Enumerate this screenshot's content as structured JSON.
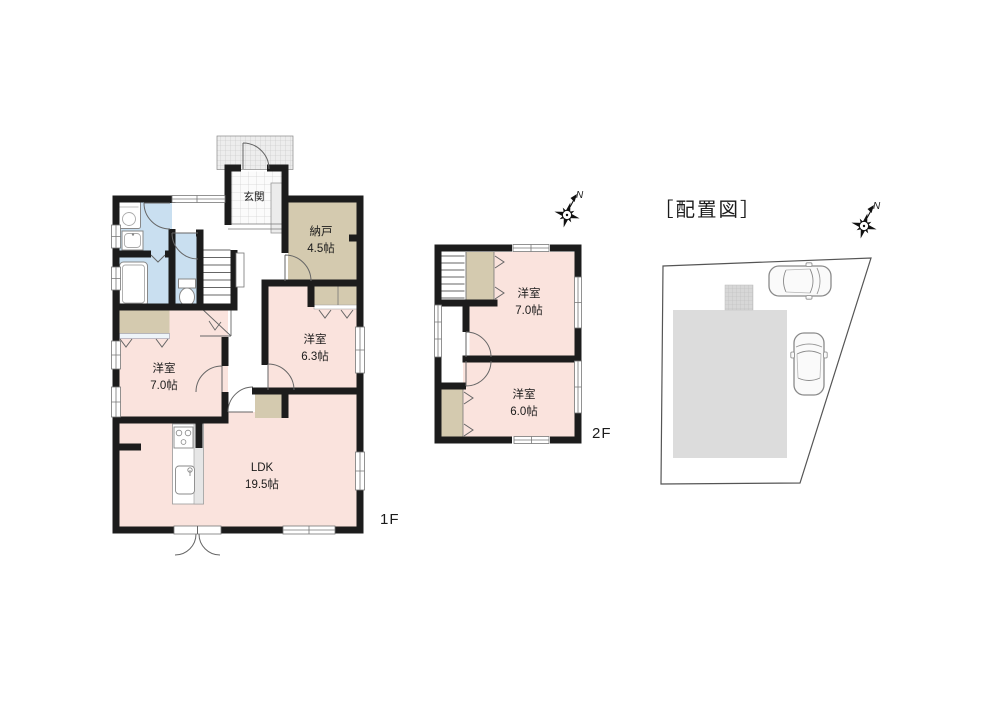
{
  "document": {
    "type": "floor-plan",
    "background": "#ffffff"
  },
  "palette": {
    "wall": "#1c1c1c",
    "room_pink": "#fae3dd",
    "closet_beige": "#d4caaf",
    "wet_area_blue": "#c9dff0",
    "building_gray": "#dcdcdc",
    "line_gray": "#666666"
  },
  "floor1": {
    "floor_label": "1F",
    "rooms": {
      "genkan": {
        "name": "玄関"
      },
      "nando": {
        "name": "納戸",
        "size": "4.5帖"
      },
      "bedroom_7": {
        "name": "洋室",
        "size": "7.0帖"
      },
      "bedroom_63": {
        "name": "洋室",
        "size": "6.3帖"
      },
      "ldk": {
        "name": "LDK",
        "size": "19.5帖"
      }
    }
  },
  "floor2": {
    "floor_label": "2F",
    "rooms": {
      "bedroom_7": {
        "name": "洋室",
        "size": "7.0帖"
      },
      "bedroom_6": {
        "name": "洋室",
        "size": "6.0帖"
      }
    }
  },
  "site_plan": {
    "title": "［配置図］"
  },
  "compass": {
    "north_label": "N"
  }
}
